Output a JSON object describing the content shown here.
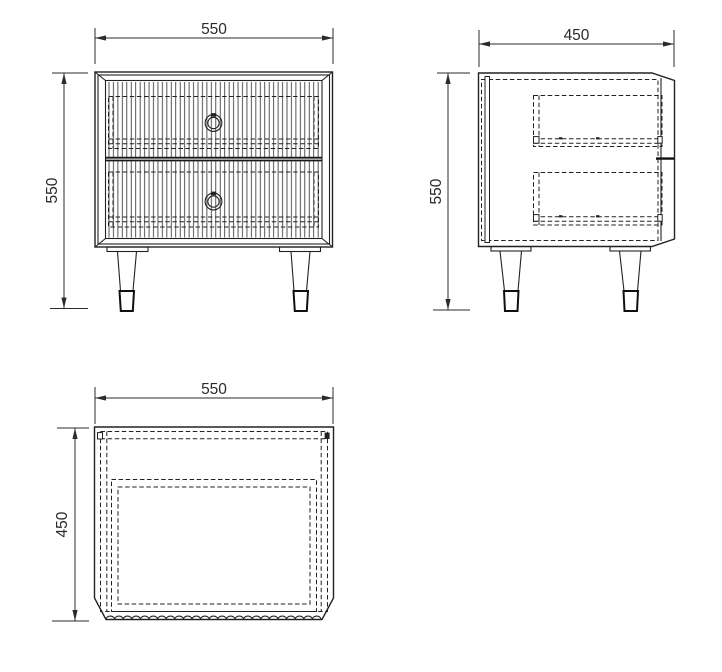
{
  "drawing": {
    "views": {
      "front": {
        "width_label": "550",
        "height_label": "550"
      },
      "side": {
        "width_label": "450",
        "height_label": "550"
      },
      "top": {
        "width_label": "550",
        "height_label": "450"
      }
    }
  },
  "colors": {
    "line": "#222222",
    "dimension": "#2b2b2b",
    "background": "#ffffff"
  }
}
